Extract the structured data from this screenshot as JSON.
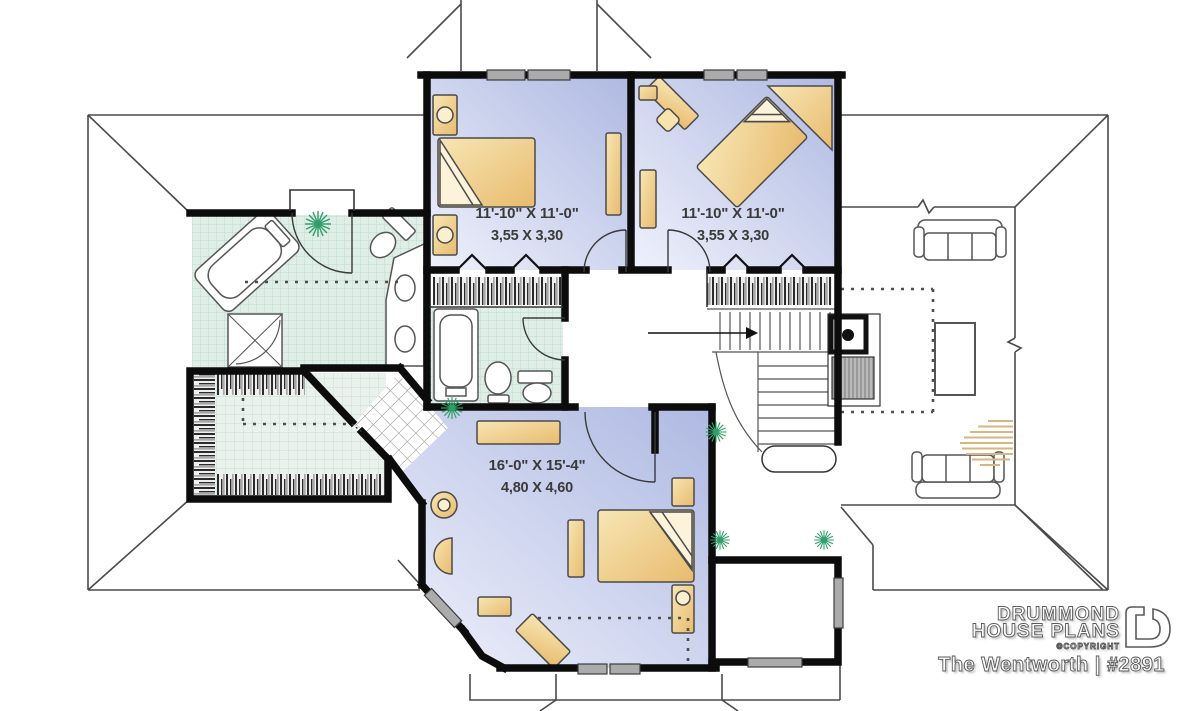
{
  "plan": {
    "rooms": {
      "bedroom1": {
        "name": "bedroom 1",
        "imperial": "11'-10\" X 11'-0\"",
        "metric": "3,55 X 3,30"
      },
      "bedroom2": {
        "name": "bedroom 2",
        "imperial": "11'-10\" X 11'-0\"",
        "metric": "3,55 X 3,30"
      },
      "master": {
        "name": "master bedroom",
        "imperial": "16'-0\" X 15'-4\"",
        "metric": "4,80 X 4,60"
      }
    }
  },
  "branding": {
    "brand_line1": "DRUMMOND",
    "brand_line2": "HOUSE PLANS",
    "copyright": "©COPYRIGHT",
    "plan_title": "The Wentworth | #2891"
  },
  "colors": {
    "wall": "#0c0c0c",
    "roof_line": "#4a4a4a",
    "floor_blue_dark": "#b4bfe6",
    "floor_blue_light": "#edf0fa",
    "tile_mint": "#dfeee7",
    "furniture_tan": "#f2d795",
    "window_gray": "#ababab",
    "plant_green": "#2f9e6a"
  }
}
